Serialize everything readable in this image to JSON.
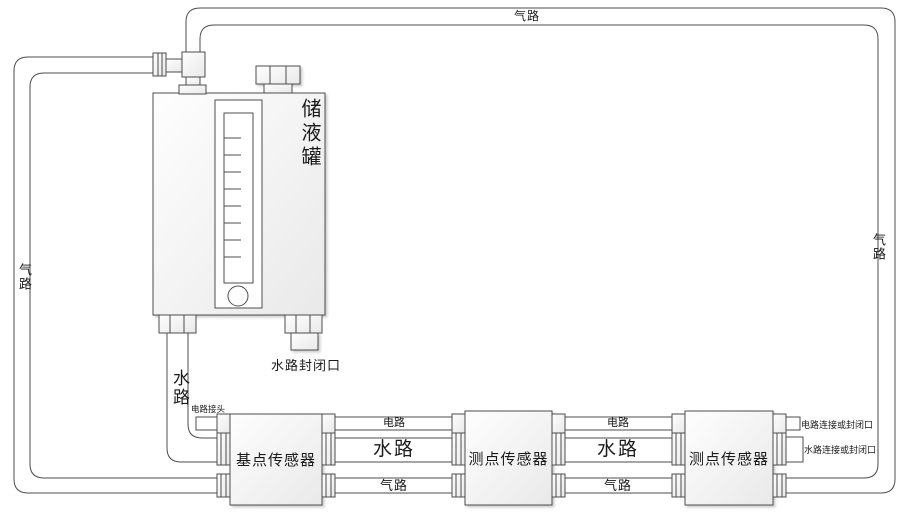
{
  "tank": {
    "label": "储液罐",
    "water_closed_port": "水路封闭口"
  },
  "pipes": {
    "gas_top": "气路",
    "gas_left": "气路",
    "gas_right": "气路",
    "water_down": "水路"
  },
  "sensors": [
    {
      "label": "基点传感器"
    },
    {
      "label": "测点传感器"
    },
    {
      "label": "测点传感器"
    }
  ],
  "segments": [
    {
      "circuit": "电路",
      "water": "水路",
      "gas": "气路"
    },
    {
      "circuit": "电路",
      "water": "水路",
      "gas": "气路"
    }
  ],
  "ports": {
    "circuit_connector": "电路接头",
    "circuit_connect_or_closed": "电路连接或封闭口",
    "water_connect_or_closed": "水路连接或封闭口"
  },
  "colors": {
    "line": "#4d4d4d",
    "text": "#1a1a1a",
    "fill_top": "#fdfdfd",
    "fill_bottom": "#ebebeb"
  }
}
